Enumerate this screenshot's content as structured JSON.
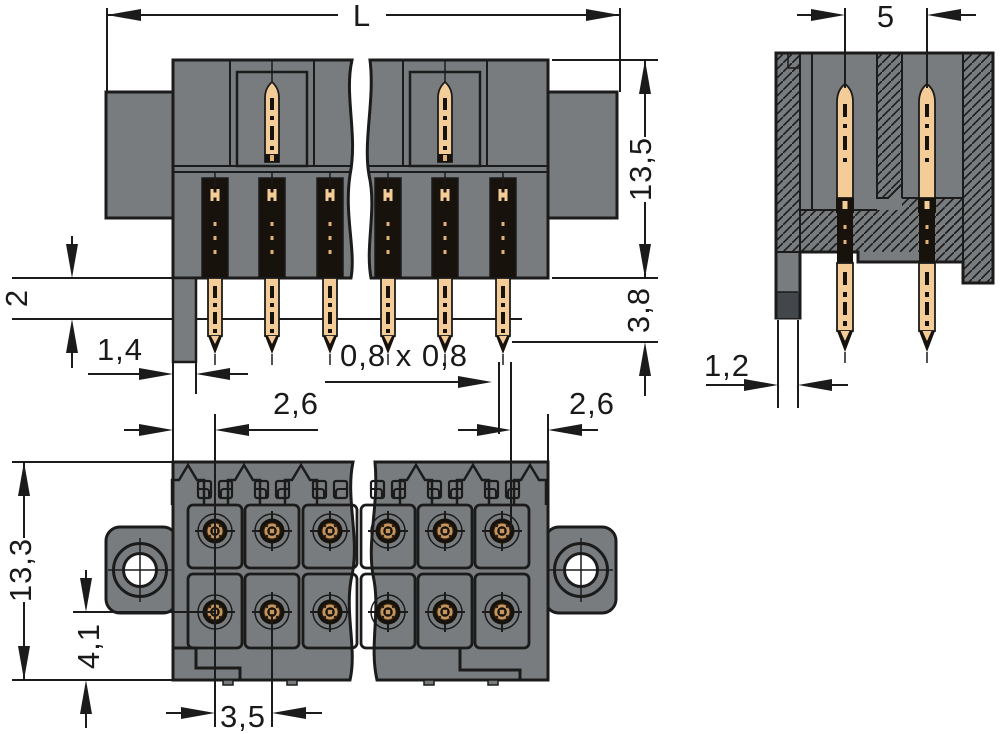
{
  "drawing": {
    "type": "connector-technical-drawing",
    "colors": {
      "background": "#ffffff",
      "body_gray": "#797C7E",
      "outline": "#1b1b1b",
      "pin_gold": "#F4CC98",
      "pin_gold_mid": "#E2B279",
      "pin_dark": "#17120C",
      "bottom_pin_gold": "#C69660",
      "foot_dark": "#43464a"
    },
    "front_view": {
      "dim_length": "L",
      "dim_height": "13,5",
      "dim_pin_protrusion": "3,8",
      "dim_standoff": "2",
      "dim_foot_width": "1,4",
      "dim_pin_square": "0,8 x 0,8",
      "dim_edge_to_pin_left": "2,6",
      "dim_edge_to_pin_right": "2,6"
    },
    "side_view": {
      "dim_row_pitch": "5",
      "dim_foot_width": "1,2"
    },
    "top_view": {
      "dim_depth": "13,3",
      "dim_row_offset": "4,1",
      "dim_pin_pitch": "3,5"
    }
  }
}
